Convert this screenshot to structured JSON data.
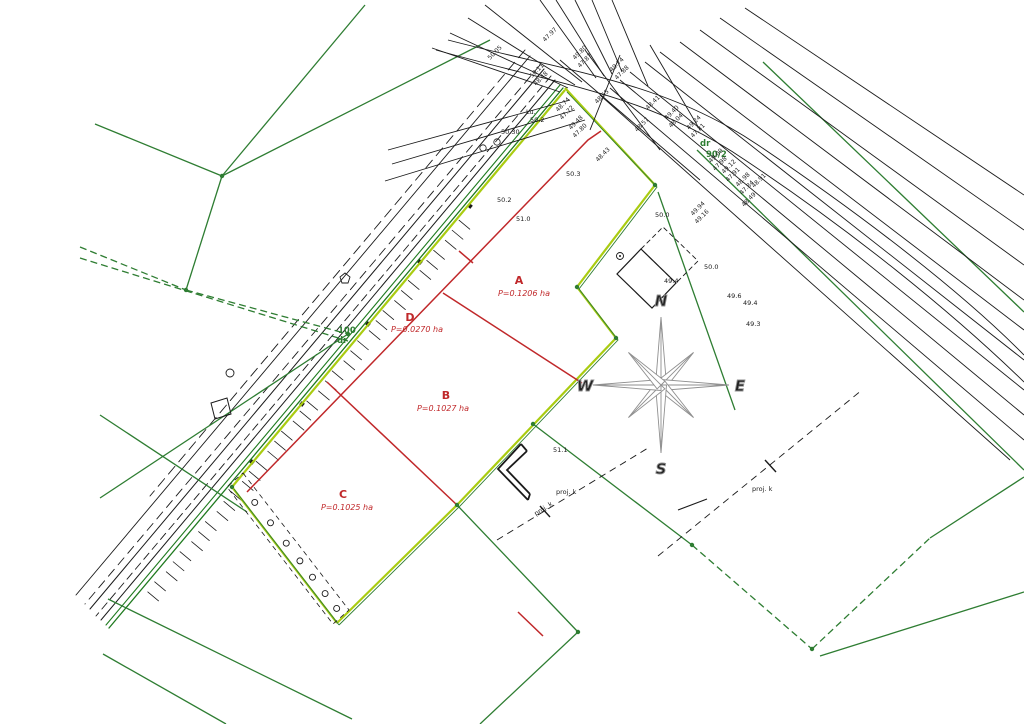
{
  "plots": [
    {
      "id": "A",
      "area": "P=0.1206 ha"
    },
    {
      "id": "B",
      "area": "P=0.1027 ha"
    },
    {
      "id": "C",
      "area": "P=0.1025 ha"
    },
    {
      "id": "D",
      "area": "P=0.0270 ha"
    }
  ],
  "roads": {
    "dr_label": "dr",
    "dr_parcel": "90/2",
    "r100": "100",
    "r100_sub": "dr"
  },
  "compass": {
    "n": "N",
    "e": "E",
    "s": "S",
    "w": "W"
  },
  "annotations": {
    "proj_k": "proj. k"
  },
  "heights": {
    "s1": "50.3",
    "s2": "50.2",
    "s3": "51.0",
    "s4": "50.0",
    "s5": "50.0",
    "s6": "49.4",
    "s7": "49.6",
    "s8": "49.4",
    "s9": "49.3",
    "s10": "51.1",
    "s11": "50.30",
    "s12": "Lu.",
    "s13": "50.2"
  },
  "cluster": {
    "c1": "49.80",
    "c2": "47.87",
    "c3": "49.74",
    "c4": "47.88",
    "c5": "47.97",
    "c6": "50.05",
    "c7": "50.11",
    "c8": "48.48",
    "c9": "48.74",
    "c10": "47.72",
    "c11": "49.48",
    "c12": "47.80",
    "c13": "48.55",
    "c14": "48.41",
    "c15": "49.40",
    "c16": "48.04",
    "c17": "48.57",
    "c18": "48.43",
    "c19": "49.24",
    "c20": "47.31",
    "c21": "49.00",
    "c22": "47.98",
    "c23": "49.12",
    "c24": "47.91",
    "c25": "48.98",
    "c26": "47.84",
    "c27": "48.91",
    "c28": "48.49",
    "c29": "49.94",
    "c30": "49.16"
  },
  "colors": {
    "boundary_green": "#2e7d32",
    "survey_red": "#c0282a",
    "chartreuse": "#aacc11",
    "ink": "#1a1a1a",
    "compass_gray": "#8f8f8f"
  }
}
